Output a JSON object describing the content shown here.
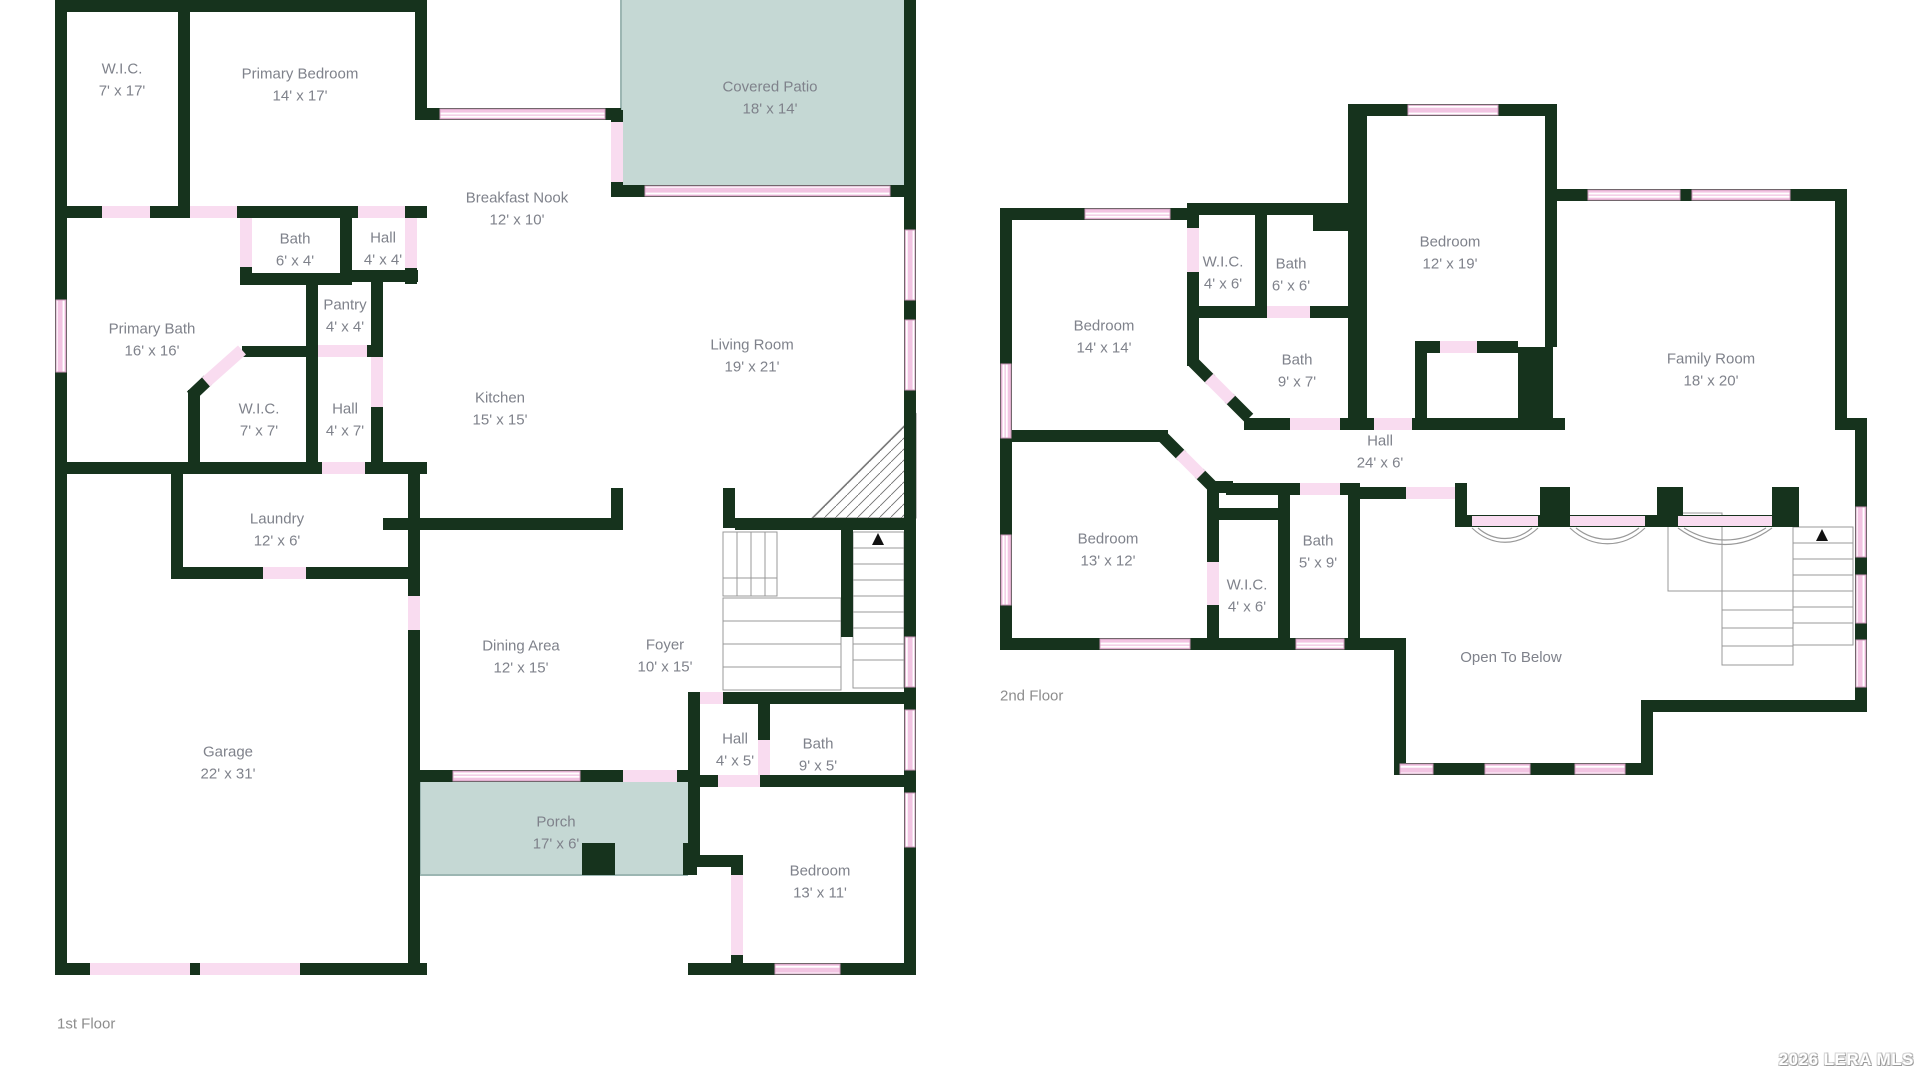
{
  "watermark": {
    "text": "2026 LERA MLS"
  },
  "colors": {
    "wall": "#16331d",
    "door": "#f9dcf0",
    "window_fill": "#f2c4e2",
    "window_border": "#cf9abc",
    "patio": "#c5d8d4",
    "stair_line": "#999999",
    "label_text": "#7f828b"
  },
  "floors": [
    {
      "label": "1st Floor",
      "rooms": [
        {
          "name": "W.I.C.",
          "dims": "7' x 17'"
        },
        {
          "name": "Primary Bedroom",
          "dims": "14' x 17'"
        },
        {
          "name": "Covered Patio",
          "dims": "18' x 14'"
        },
        {
          "name": "Breakfast Nook",
          "dims": "12' x 10'"
        },
        {
          "name": "Bath",
          "dims": "6' x 4'"
        },
        {
          "name": "Hall",
          "dims": "4' x 4'"
        },
        {
          "name": "Primary Bath",
          "dims": "16' x 16'"
        },
        {
          "name": "Pantry",
          "dims": "4' x 4'"
        },
        {
          "name": "W.I.C.",
          "dims": "7' x 7'"
        },
        {
          "name": "Hall",
          "dims": "4' x 7'"
        },
        {
          "name": "Kitchen",
          "dims": "15' x 15'"
        },
        {
          "name": "Living Room",
          "dims": "19' x 21'"
        },
        {
          "name": "Laundry",
          "dims": "12' x 6'"
        },
        {
          "name": "Dining Area",
          "dims": "12' x 15'"
        },
        {
          "name": "Foyer",
          "dims": "10' x 15'"
        },
        {
          "name": "Garage",
          "dims": "22' x 31'"
        },
        {
          "name": "Hall",
          "dims": "4' x 5'"
        },
        {
          "name": "Bath",
          "dims": "9' x 5'"
        },
        {
          "name": "Porch",
          "dims": "17' x 6'"
        },
        {
          "name": "Bedroom",
          "dims": "13' x 11'"
        }
      ]
    },
    {
      "label": "2nd Floor",
      "rooms": [
        {
          "name": "Bedroom",
          "dims": "14' x 14'"
        },
        {
          "name": "W.I.C.",
          "dims": "4' x 6'"
        },
        {
          "name": "Bath",
          "dims": "6' x 6'"
        },
        {
          "name": "Bedroom",
          "dims": "12' x 19'"
        },
        {
          "name": "Bath",
          "dims": "9' x 7'"
        },
        {
          "name": "Family Room",
          "dims": "18' x 20'"
        },
        {
          "name": "Hall",
          "dims": "24' x 6'"
        },
        {
          "name": "Bedroom",
          "dims": "13' x 12'"
        },
        {
          "name": "Bath",
          "dims": "5' x 9'"
        },
        {
          "name": "W.I.C.",
          "dims": "4' x 6'"
        },
        {
          "name": "Open To Below",
          "dims": ""
        }
      ]
    }
  ]
}
